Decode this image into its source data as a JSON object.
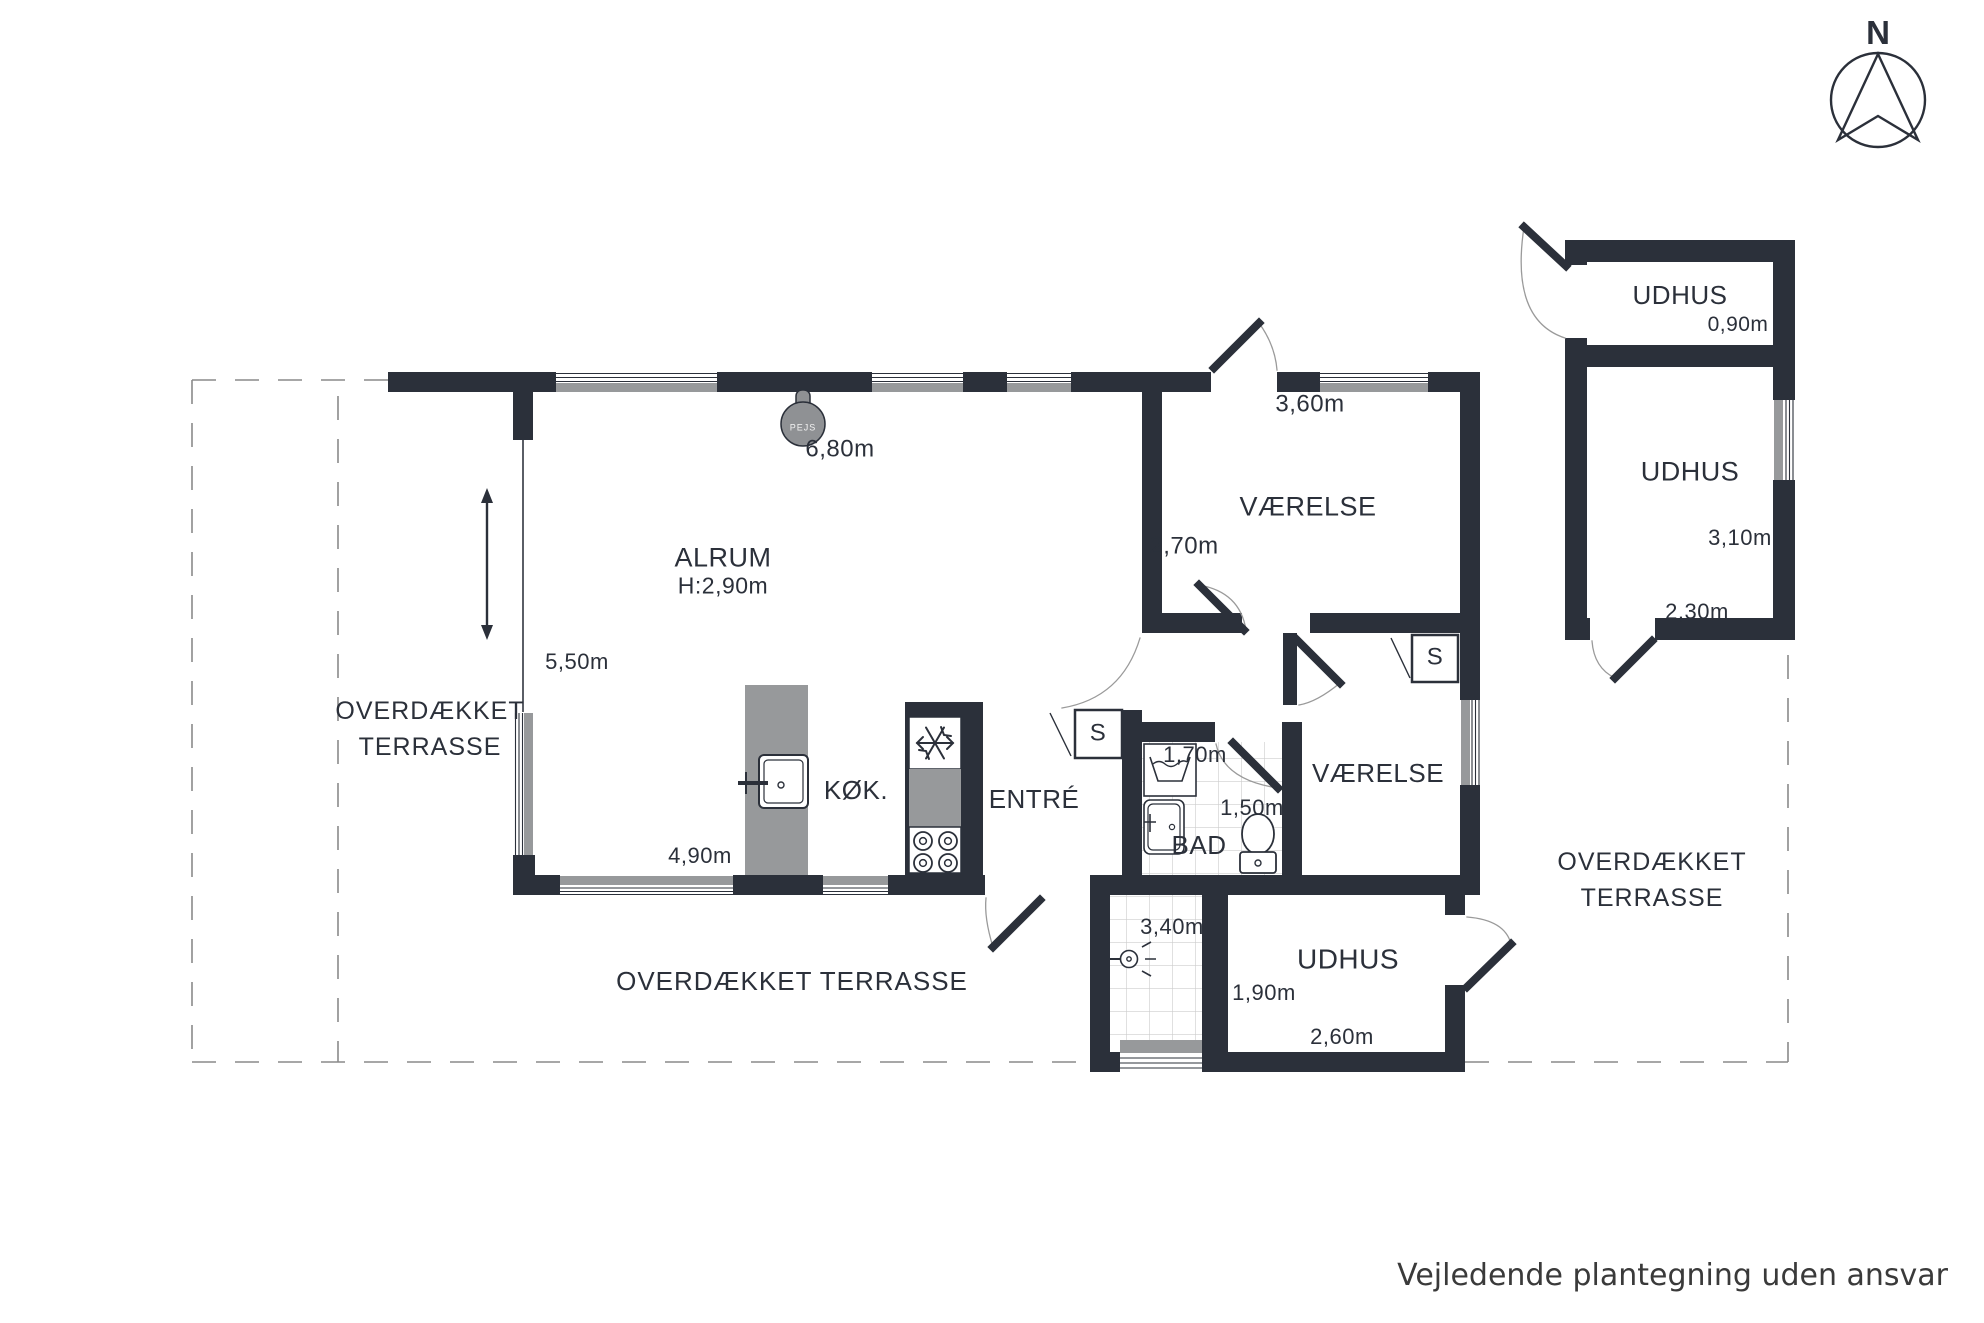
{
  "compass": {
    "north": "N"
  },
  "plan": {
    "alrum": {
      "name": "ALRUM",
      "height": "H:2,90m",
      "w_top": "6,80m",
      "w_side": "5,50m",
      "w_bottom": "4,90m"
    },
    "kitchen": {
      "name": "KØK."
    },
    "entre": {
      "name": "ENTRÉ"
    },
    "room1": {
      "name": "VÆRELSE",
      "w": "3,60m",
      "d": "2,70m"
    },
    "room2": {
      "name": "VÆRELSE"
    },
    "bad": {
      "name": "BAD",
      "d1": "1,70m",
      "d2": "1,50m"
    },
    "hallway": {
      "d": "3,40m"
    },
    "shed": {
      "name": "UDHUS",
      "d": "1,90m",
      "w": "2,60m"
    },
    "outbuilding": {
      "top": {
        "name": "UDHUS",
        "d": "0,90m"
      },
      "main": {
        "name": "UDHUS",
        "d": "3,10m",
        "w": "2,30m"
      }
    },
    "closet1": "S",
    "closet2": "S",
    "fireplace": "PEJS"
  },
  "terraces": {
    "left": "OVERDÆKKET TERRASSE",
    "bottom": "OVERDÆKKET TERRASSE",
    "right": "OVERDÆKKET TERRASSE"
  },
  "footer": {
    "disclaimer": "Vejledende plantegning uden ansvar"
  },
  "colors": {
    "wall": "#2b303a",
    "furniture_gray": "#97999b",
    "pejs_gray": "#8f9194",
    "text": "#2b303a"
  }
}
